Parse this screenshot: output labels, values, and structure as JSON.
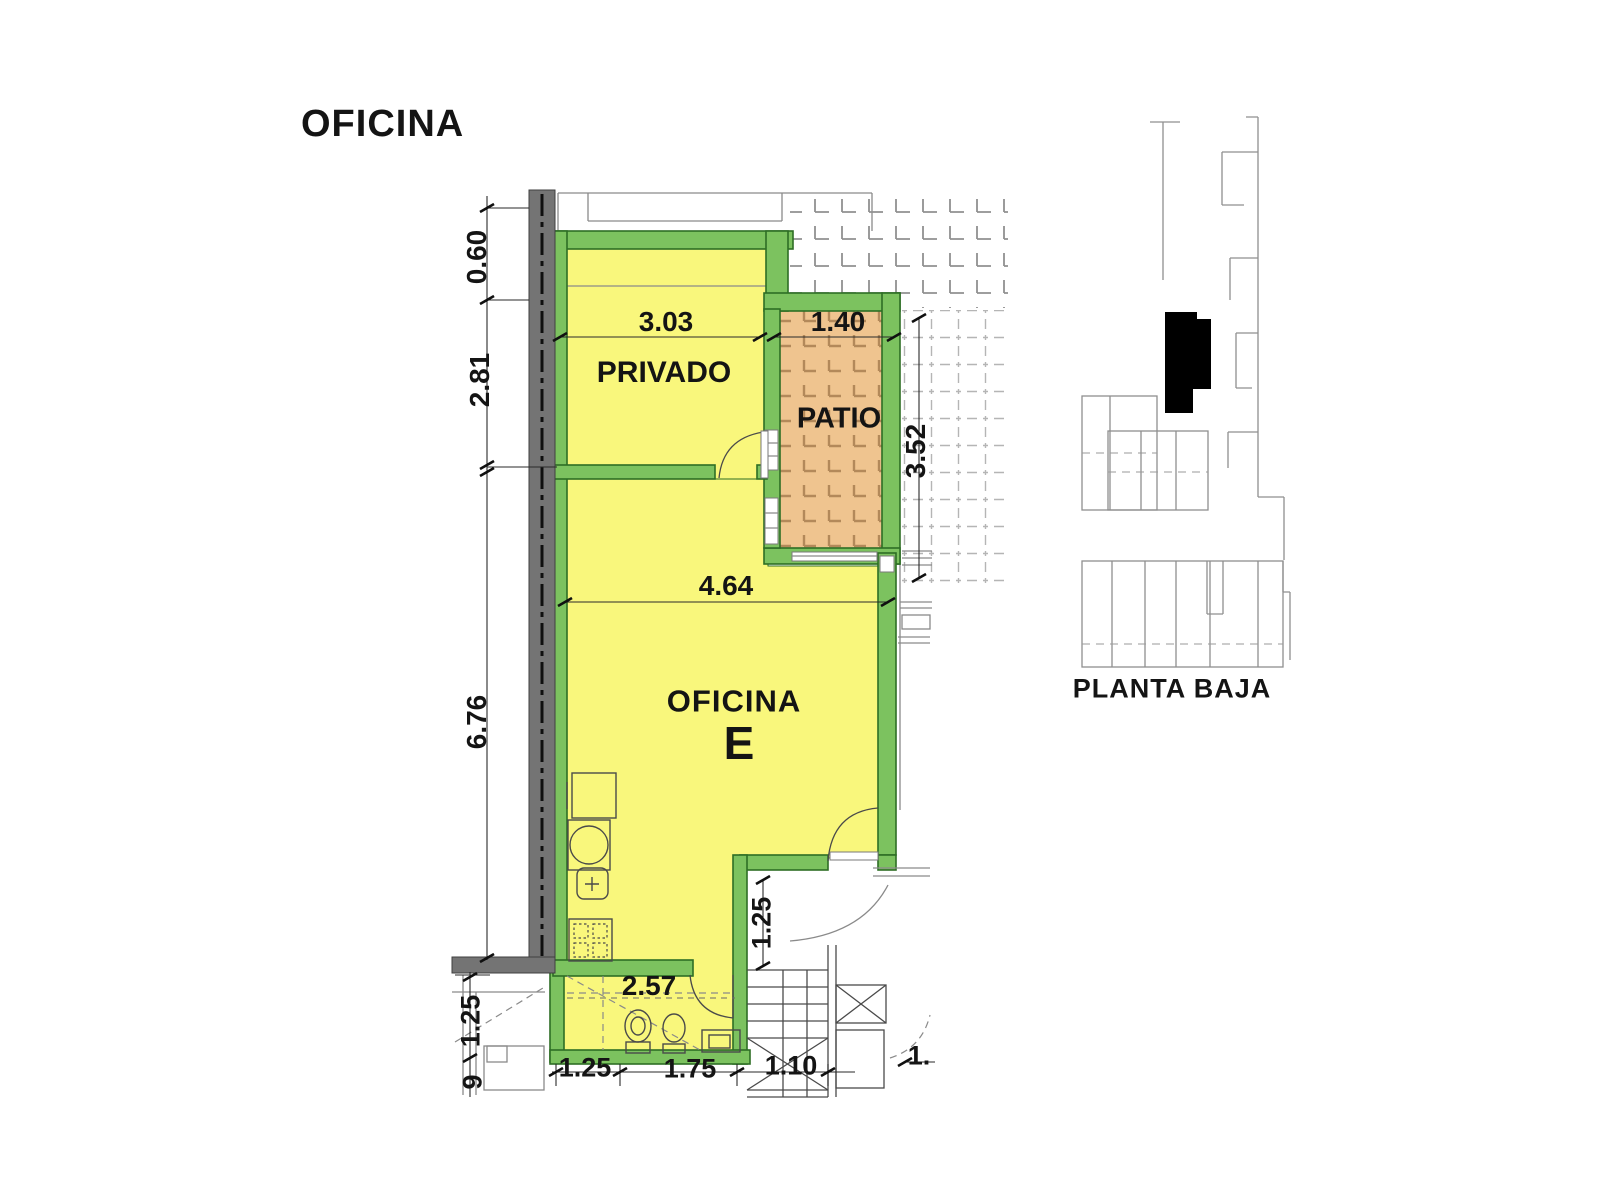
{
  "title": "OFICINA",
  "rooms": {
    "privado": "PRIVADO",
    "patio": "PATIO",
    "office": "OFICINA",
    "office_unit": "E"
  },
  "dims": {
    "left_top": "0.60",
    "left_mid": "2.81",
    "left_main": "6.76",
    "privado_width": "3.03",
    "patio_width": "1.40",
    "patio_height": "3.52",
    "office_width": "4.64",
    "bath_width": "2.57",
    "hall_depth": "1.25",
    "bottom_left_a": "1.25",
    "bottom_left_b": "9",
    "bottom_a": "1.25",
    "bottom_b": "1.75",
    "bottom_c": "1.10",
    "bottom_d": "1."
  },
  "key_plan": {
    "caption": "PLANTA BAJA"
  },
  "colors": {
    "room_fill": "#f9f77c",
    "wall_green": "#7cc25f",
    "wall_green_dark": "#2e6e25",
    "patio_fill": "#efc48f",
    "patio_grid": "#b3895a",
    "party_wall": "#747474",
    "plan_line": "#4a4a4a",
    "neighbor_line": "#8a8a8a",
    "tile_gray": "#909090",
    "dash_tile": "#b5b5b5",
    "text": "#141414"
  }
}
